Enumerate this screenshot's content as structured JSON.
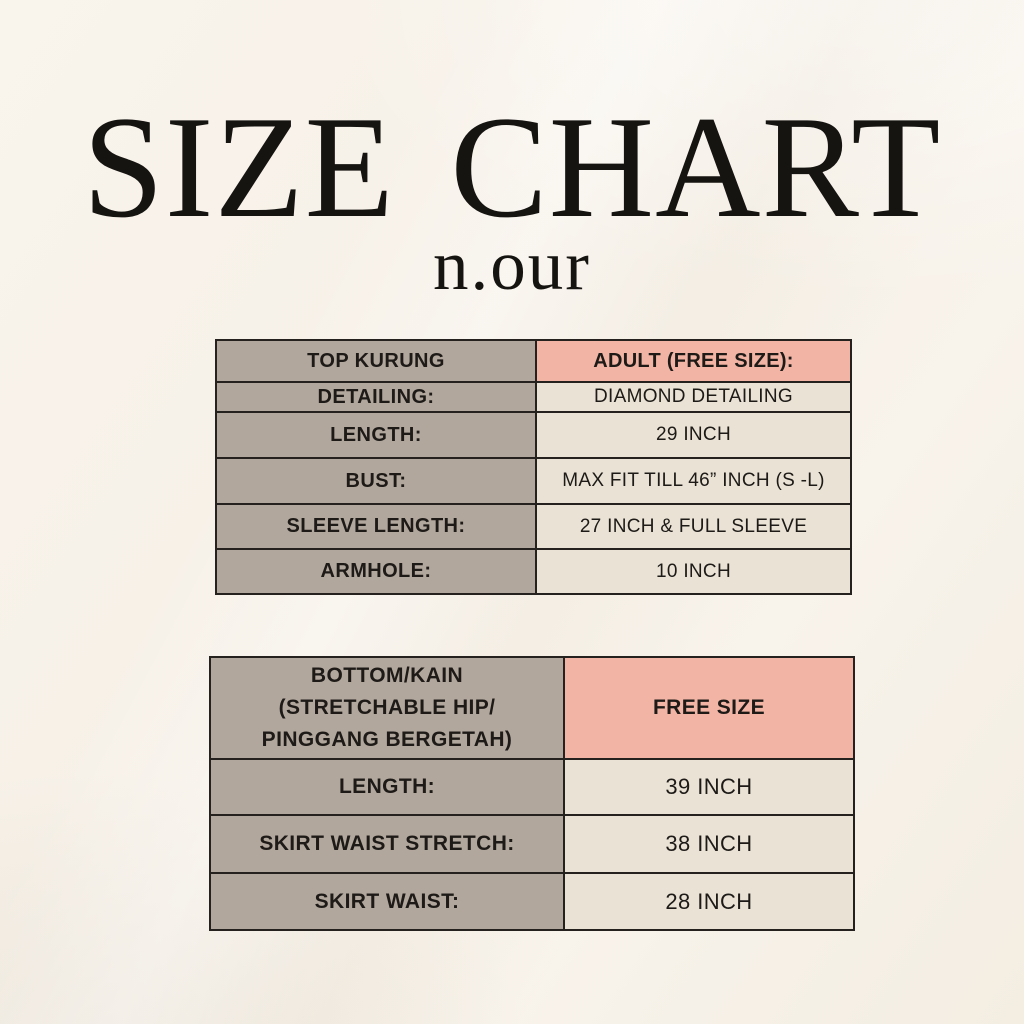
{
  "header": {
    "title": "SIZE CHART",
    "brand": "n.our"
  },
  "colors": {
    "page-bg": "#f7f1e8",
    "cell-taupe": "#b2a79d",
    "cell-pink": "#f2b4a4",
    "cell-cream": "#e9e2d5",
    "border": "#24211e",
    "text": "#1d1a17"
  },
  "table_top": {
    "header": {
      "label": "TOP KURUNG",
      "value": "ADULT (FREE SIZE):"
    },
    "rows": [
      {
        "label": "DETAILING:",
        "value": "DIAMOND DETAILING"
      },
      {
        "label": "LENGTH:",
        "value": "29 INCH"
      },
      {
        "label": "BUST:",
        "value": "MAX FIT TILL 46” INCH (S -L)"
      },
      {
        "label": "SLEEVE LENGTH:",
        "value": "27 INCH & FULL SLEEVE"
      },
      {
        "label": "ARMHOLE:",
        "value": "10 INCH"
      }
    ]
  },
  "table_bottom": {
    "header": {
      "lines": [
        "BOTTOM/KAIN",
        "(STRETCHABLE HIP/",
        "PINGGANG BERGETAH)"
      ],
      "value": "FREE SIZE"
    },
    "rows": [
      {
        "label": "LENGTH:",
        "value": "39 INCH"
      },
      {
        "label": "SKIRT WAIST STRETCH:",
        "value": "38 INCH"
      },
      {
        "label": "SKIRT WAIST:",
        "value": "28 INCH"
      }
    ]
  }
}
